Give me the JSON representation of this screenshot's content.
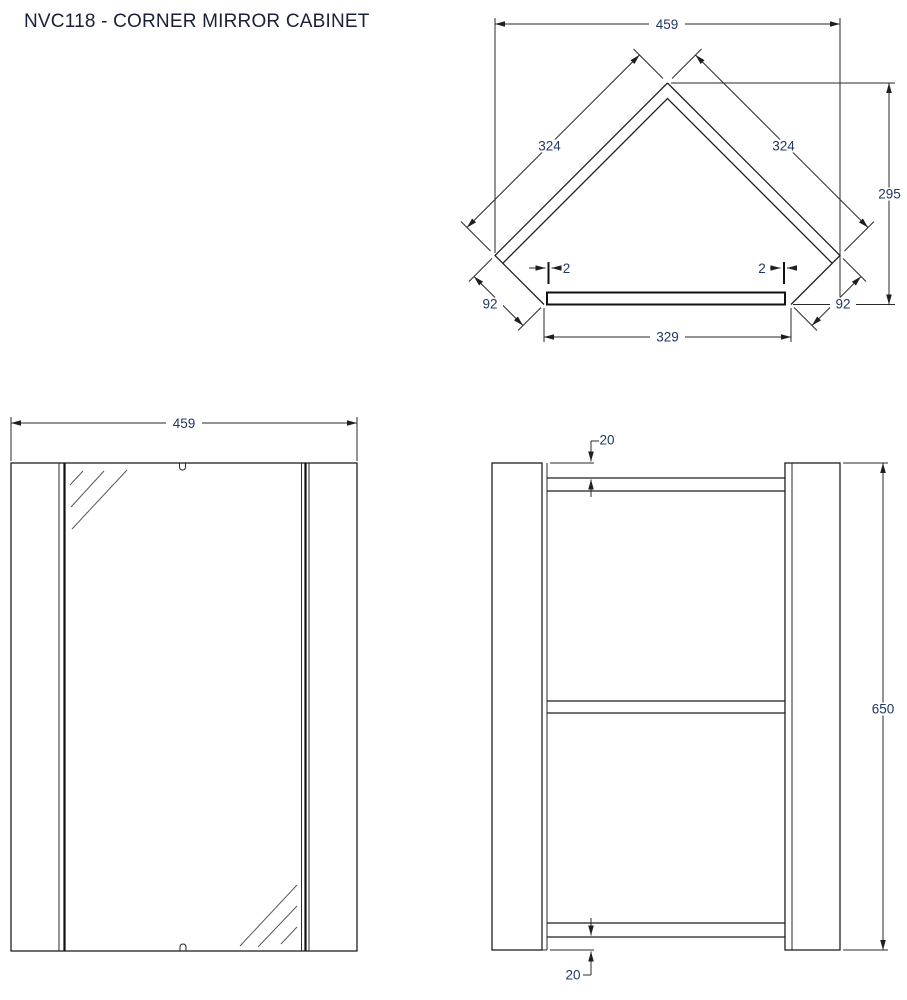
{
  "title": "NVC118 - CORNER MIRROR CABINET",
  "product_code": "NVC118",
  "product_name": "CORNER MIRROR CABINET",
  "colors": {
    "line": "#1f1f1f",
    "dim_text": "#1f3864",
    "background": "#ffffff"
  },
  "views": {
    "plan": {
      "dims": {
        "overall_width": "459",
        "left_side_length": "324",
        "right_side_length": "324",
        "overall_depth": "295",
        "left_return": "92",
        "right_return": "92",
        "door_gap_left": "2",
        "door_gap_right": "2",
        "front_door_width": "329"
      }
    },
    "front": {
      "dims": {
        "overall_width": "459"
      }
    },
    "side": {
      "dims": {
        "top_recess": "20",
        "overall_height": "650",
        "bottom_recess": "20"
      }
    }
  }
}
